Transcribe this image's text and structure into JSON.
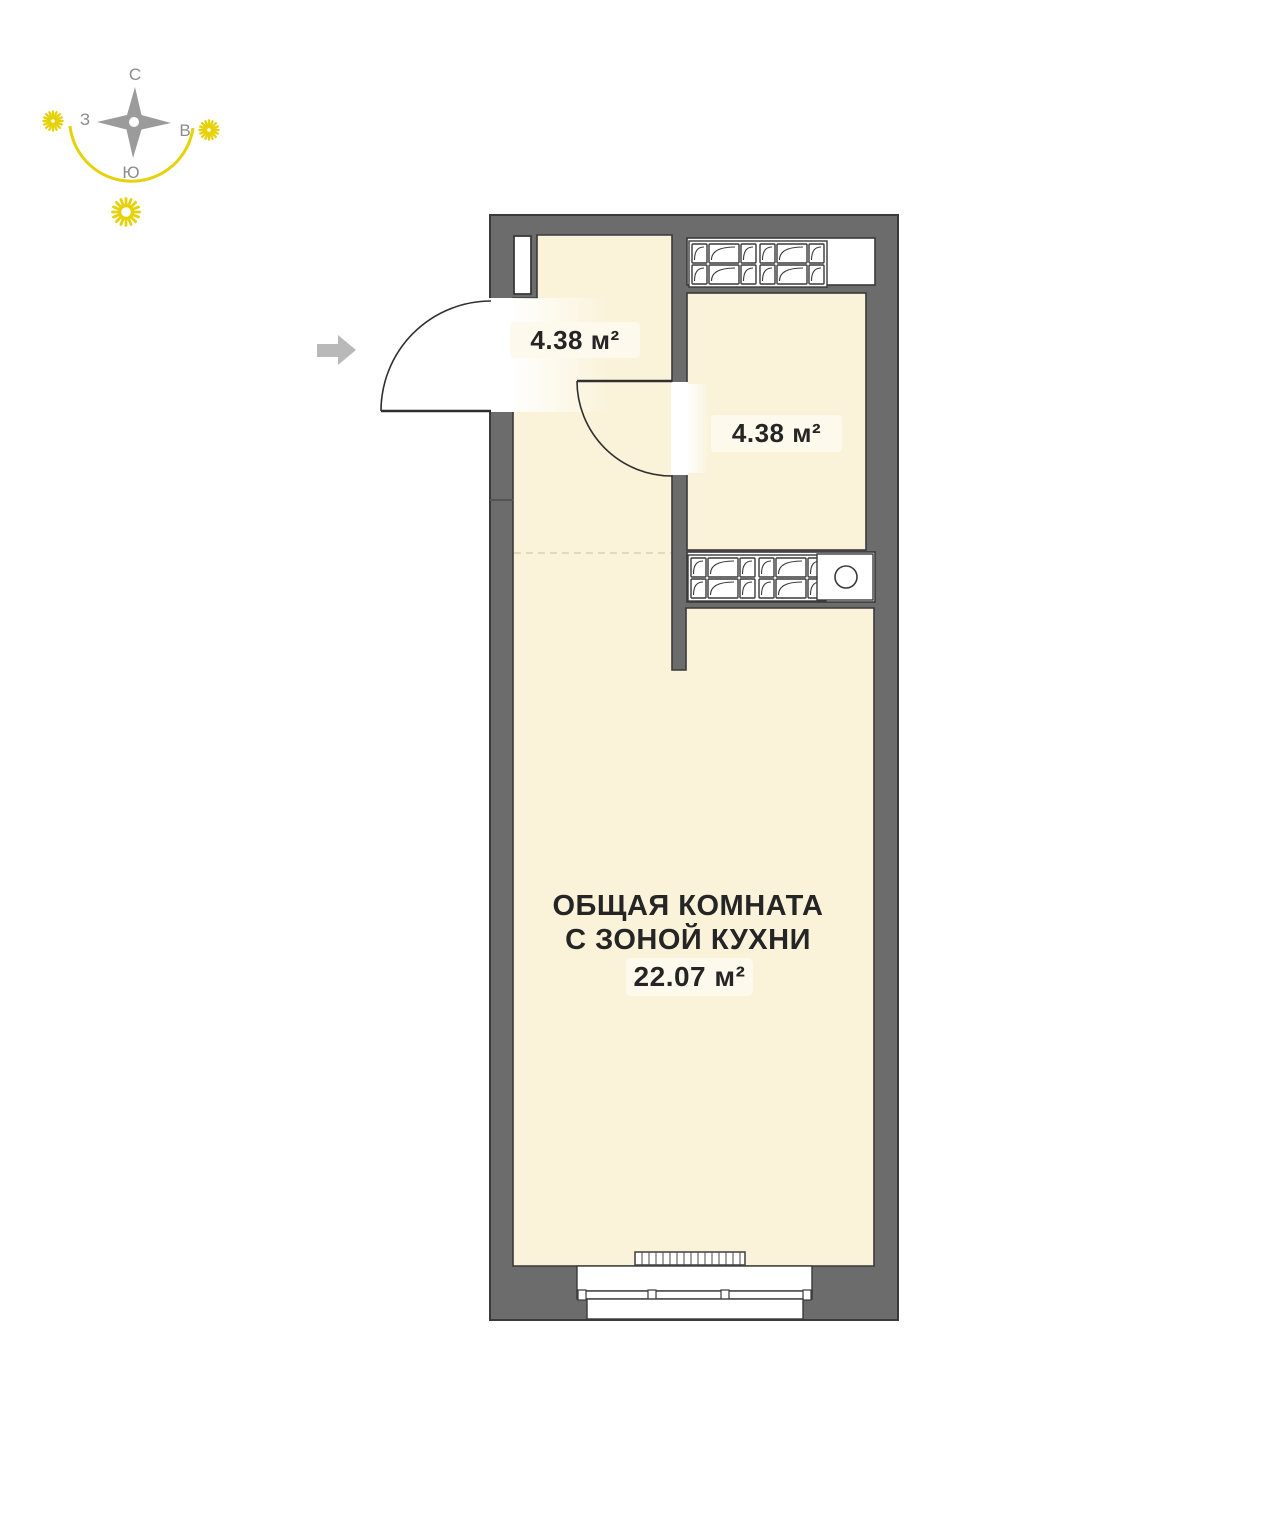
{
  "compass": {
    "north_label": "С",
    "east_label": "В",
    "south_label": "Ю",
    "west_label": "З"
  },
  "rooms": {
    "hallway": {
      "area": "4.38 м²"
    },
    "bathroom": {
      "area": "4.38 м²"
    },
    "living": {
      "name_line1": "ОБЩАЯ КОМНАТА",
      "name_line2": "С ЗОНОЙ КУХНИ",
      "area": "22.07 м²"
    }
  },
  "icons": {
    "compass_rose": "four-point-star",
    "sun_west": "sun-burst",
    "sun_east": "sun-burst",
    "sun_south": "sun-ring",
    "entrance_arrow": "right-block-arrow",
    "sink": "circle",
    "vent_blocks": "cells-with-arc",
    "radiator": "hatched-bar"
  },
  "colors": {
    "wall": "#6c6c6c",
    "wall_outline": "#3a3a3a",
    "floor": "#faf3da",
    "fixture_white": "#ffffff",
    "accent_yellow": "#e6d20a",
    "label_bg": "#fdf9ec",
    "text": "#252525",
    "compass_gray": "#9b9b9b",
    "arrow_gray": "#b9b9b9",
    "zone_dash": "#d9d1b5"
  }
}
